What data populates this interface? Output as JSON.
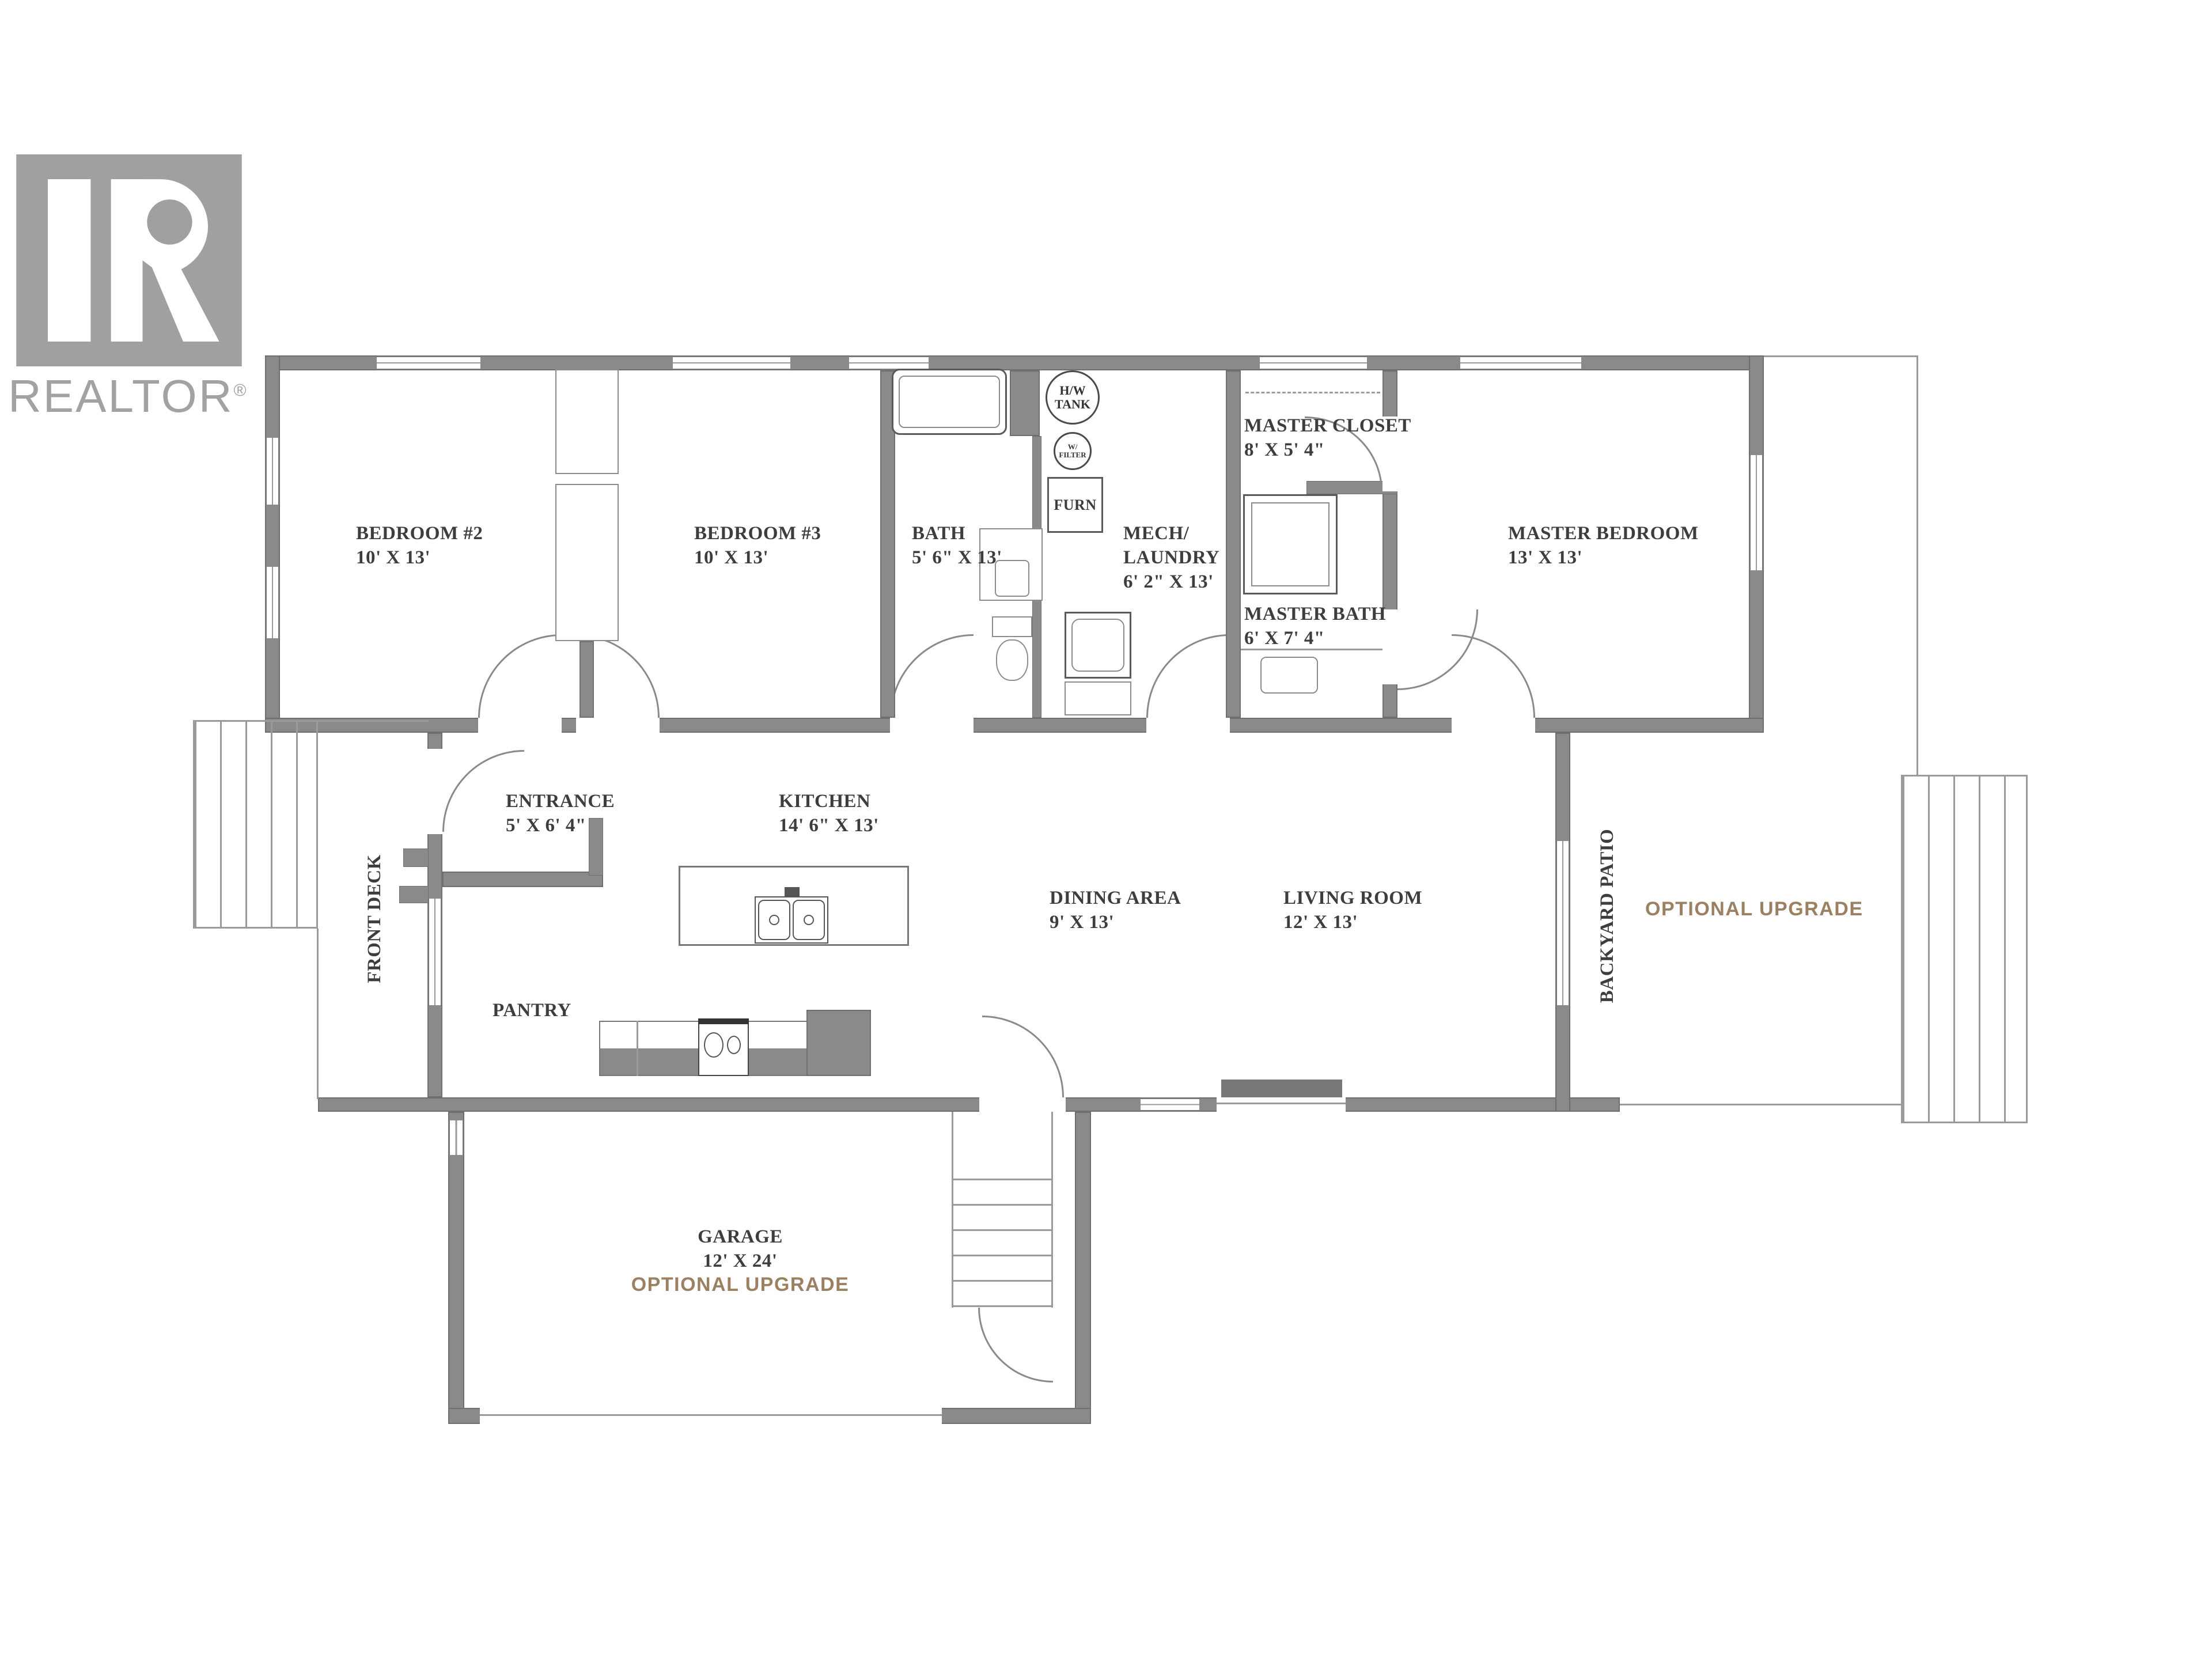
{
  "logo": {
    "brand": "REALTOR",
    "reg": "®"
  },
  "rooms": {
    "bedroom2": {
      "name": "BEDROOM #2",
      "dims": "10' X 13'"
    },
    "bedroom3": {
      "name": "BEDROOM #3",
      "dims": "10' X 13'"
    },
    "bath": {
      "name": "BATH",
      "dims": "5' 6\" X 13'"
    },
    "mech_laundry": {
      "name": "MECH/",
      "name2": "LAUNDRY",
      "dims": "6' 2\" X 13'"
    },
    "master_closet": {
      "name": "MASTER CLOSET",
      "dims": "8' X 5' 4\""
    },
    "master_bath": {
      "name": "MASTER BATH",
      "dims": "6' X 7' 4\""
    },
    "master_bedroom": {
      "name": "MASTER BEDROOM",
      "dims": "13' X 13'"
    },
    "entrance": {
      "name": "ENTRANCE",
      "dims": "5' X 6' 4\""
    },
    "kitchen": {
      "name": "KITCHEN",
      "dims": "14' 6\" X 13'"
    },
    "dining_area": {
      "name": "DINING AREA",
      "dims": "9' X 13'"
    },
    "living_room": {
      "name": "LIVING ROOM",
      "dims": "12' X 13'"
    },
    "pantry": {
      "name": "PANTRY"
    },
    "front_deck": {
      "name": "FRONT DECK"
    },
    "backyard_patio": {
      "name": "BACKYARD PATIO"
    },
    "garage": {
      "name": "GARAGE",
      "dims": "12' X 24'"
    }
  },
  "fixtures": {
    "hw_tank_line1": "H/W",
    "hw_tank_line2": "TANK",
    "filter_line1": "W/",
    "filter_line2": "FILTER",
    "furnace": "FURN"
  },
  "notes": {
    "patio_upgrade": "OPTIONAL UPGRADE",
    "garage_upgrade": "OPTIONAL UPGRADE"
  },
  "colors": {
    "wall": "#8a8a8a",
    "wall_edge": "#6f6f6f",
    "thin_line": "#9a9a9a",
    "label_text": "#3d3d3d",
    "upgrade_note": "#9b8062",
    "logo_gray": "#a2a2a2"
  }
}
